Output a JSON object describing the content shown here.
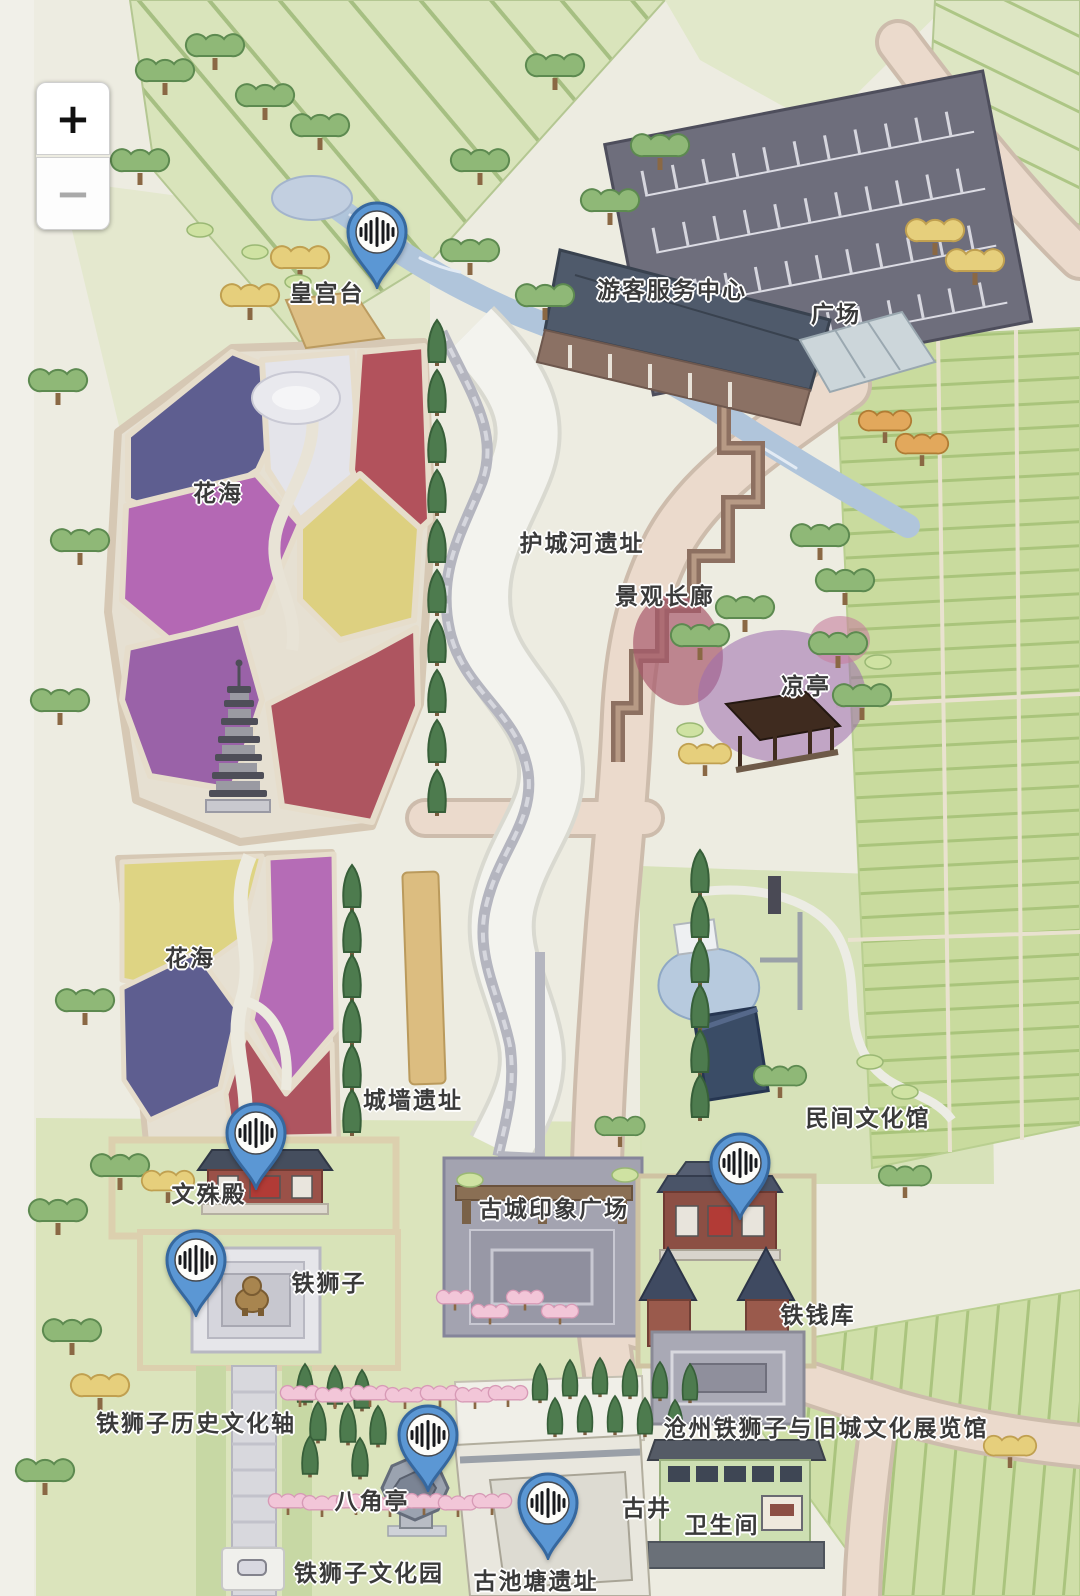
{
  "map_controls": {
    "zoom_in_label": "+",
    "zoom_out_label": "−"
  },
  "labels": [
    {
      "id": "huang-gong-tai",
      "text": "皇宫台"
    },
    {
      "id": "visitor-service-center",
      "text": "游客服务中心"
    },
    {
      "id": "plaza",
      "text": "广场"
    },
    {
      "id": "flower-sea-north",
      "text": "花海"
    },
    {
      "id": "moat-ruins",
      "text": "护城河遗址"
    },
    {
      "id": "landscape-corridor",
      "text": "景观长廊"
    },
    {
      "id": "cool-pavilion",
      "text": "凉亭"
    },
    {
      "id": "flower-sea-south",
      "text": "花海"
    },
    {
      "id": "city-wall-ruins",
      "text": "城墙遗址"
    },
    {
      "id": "folk-culture-hall",
      "text": "民间文化馆"
    },
    {
      "id": "wenshu-hall",
      "text": "文殊殿"
    },
    {
      "id": "ancient-city-impression-plaza",
      "text": "古城印象广场"
    },
    {
      "id": "iron-lion",
      "text": "铁狮子"
    },
    {
      "id": "iron-coin-vault",
      "text": "铁钱库"
    },
    {
      "id": "iron-lion-history-culture-axis",
      "text": "铁狮子历史文化轴"
    },
    {
      "id": "cangzhou-exhibition-hall",
      "text": "沧州铁狮子与旧城文化展览馆"
    },
    {
      "id": "octagonal-pavilion",
      "text": "八角亭"
    },
    {
      "id": "ancient-well",
      "text": "古井"
    },
    {
      "id": "restroom",
      "text": "卫生间"
    },
    {
      "id": "iron-lion-culture-park",
      "text": "铁狮子文化园"
    },
    {
      "id": "ancient-pond-ruins",
      "text": "古池塘遗址"
    }
  ],
  "audio_pins": [
    {
      "id": "pin-huang-gong-tai",
      "location": "皇宫台"
    },
    {
      "id": "pin-wenshu-hall",
      "location": "文殊殿"
    },
    {
      "id": "pin-iron-lion",
      "location": "铁狮子"
    },
    {
      "id": "pin-iron-coin-vault",
      "location": "铁钱库"
    },
    {
      "id": "pin-octagonal-pavilion",
      "location": "八角亭"
    },
    {
      "id": "pin-ancient-pond-ruins",
      "location": "古池塘遗址"
    }
  ],
  "colors": {
    "pin_blue": "#5b97d4",
    "pin_outline": "#36689f",
    "road": "#ebdacc",
    "farmland": "#c9db9e",
    "river": "#b0c5db",
    "label_text": "#3a3a3a"
  }
}
